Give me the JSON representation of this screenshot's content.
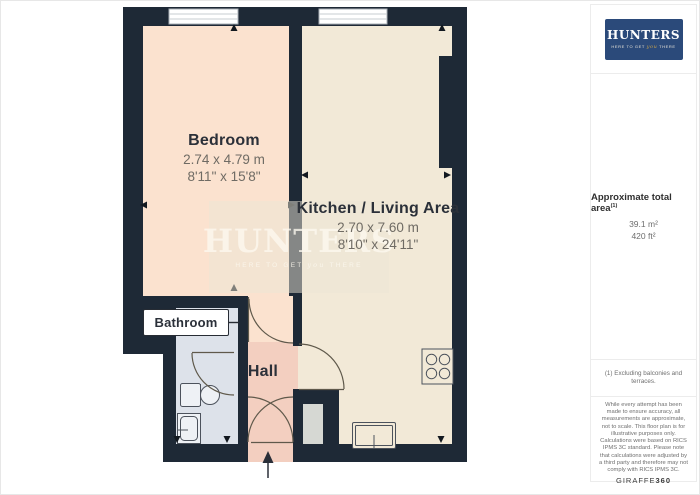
{
  "plan": {
    "rooms": {
      "bedroom": {
        "name": "Bedroom",
        "dims_m": "2.74 x 4.79 m",
        "dims_ft": "8'11\" x 15'8\""
      },
      "kitchen": {
        "name": "Kitchen / Living Area",
        "dims_m": "2.70 x 7.60 m",
        "dims_ft": "8'10\" x 24'11\""
      },
      "bathroom": {
        "name": "Bathroom"
      },
      "hall": {
        "name": "Hall"
      }
    }
  },
  "brand": {
    "title": "HUNTERS",
    "tagline_pre": "HERE TO GET",
    "tagline_script": "you",
    "tagline_post": "THERE"
  },
  "sidebar": {
    "area": {
      "heading": "Approximate total area",
      "footnote_ref": "(1)",
      "m2": "39.1 m²",
      "ft2": "420 ft²"
    },
    "footnote": "(1) Excluding balconies and terraces.",
    "disclaimer1": "While every attempt has been made to ensure accuracy, all measurements are approximate, not to scale. This floor plan is for illustrative purposes only.",
    "disclaimer2": "Calculations were based on RICS IPMS 3C standard. Please note that calculations were adjusted by a third party and therefore may not comply with RICS IPMS 3C.",
    "brand_name": "GIRAFFE",
    "brand_suffix": "360"
  },
  "colors": {
    "wall": "#1e2936",
    "bedroom_floor": "#fbe2cf",
    "kitchen_floor": "#f2e9d7",
    "hall_floor": "#f3cfc0",
    "bathroom_floor": "#dde2ea",
    "logo_navy": "#2b4a7a",
    "tagline_gold": "#c8a24b"
  }
}
